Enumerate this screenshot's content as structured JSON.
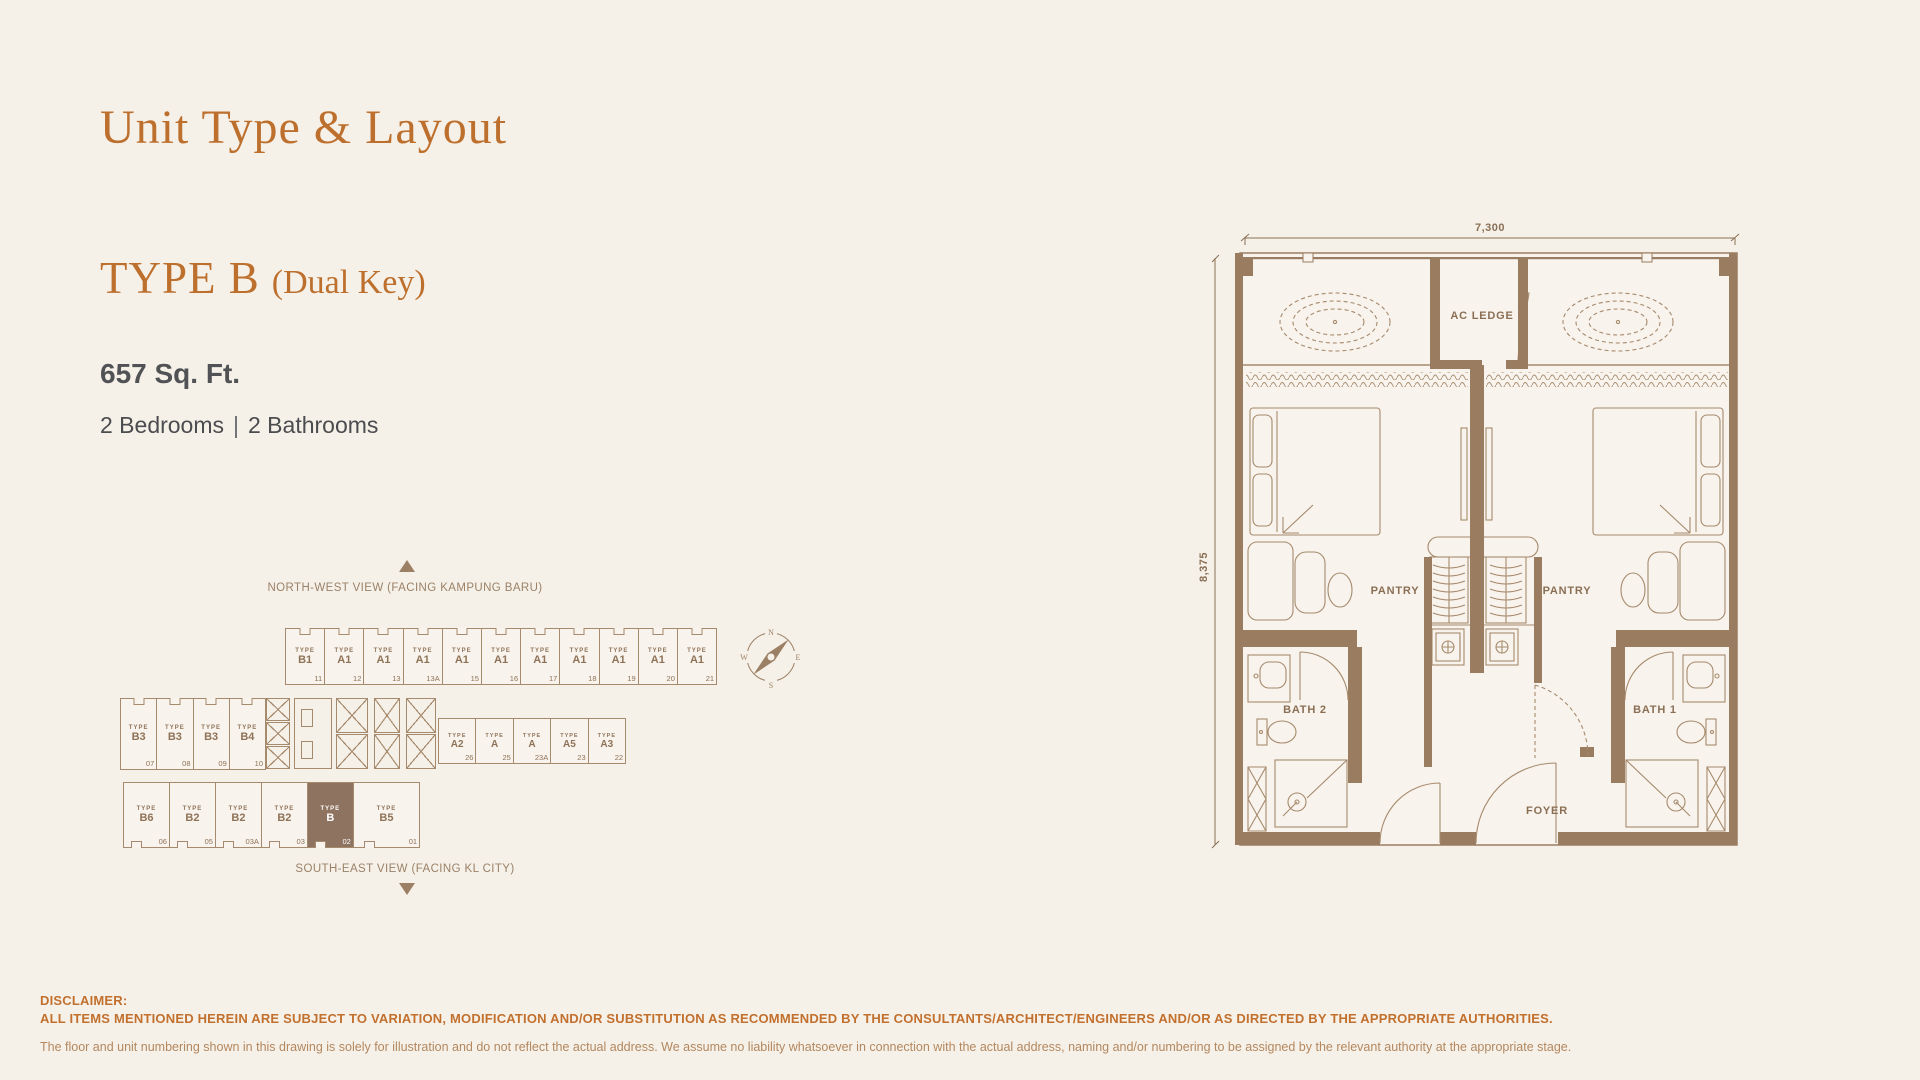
{
  "header": {
    "title": "Unit Type & Layout",
    "unit_type": "TYPE B",
    "unit_qualifier": "(Dual Key)",
    "area": "657 Sq. Ft.",
    "bedrooms": "2 Bedrooms",
    "divider": "|",
    "bathrooms": "2 Bathrooms"
  },
  "floorplate": {
    "type_prefix": "TYPE",
    "north_label": "NORTH-WEST VIEW (FACING KAMPUNG BARU)",
    "south_label": "SOUTH-EAST VIEW (FACING KL CITY)",
    "compass": {
      "n": "N",
      "e": "E",
      "s": "S",
      "w": "W"
    },
    "rows": {
      "top": [
        {
          "type": "B1",
          "no": "11"
        },
        {
          "type": "A1",
          "no": "12"
        },
        {
          "type": "A1",
          "no": "13"
        },
        {
          "type": "A1",
          "no": "13A"
        },
        {
          "type": "A1",
          "no": "15"
        },
        {
          "type": "A1",
          "no": "16"
        },
        {
          "type": "A1",
          "no": "17"
        },
        {
          "type": "A1",
          "no": "18"
        },
        {
          "type": "A1",
          "no": "19"
        },
        {
          "type": "A1",
          "no": "20"
        },
        {
          "type": "A1",
          "no": "21"
        }
      ],
      "middle_left": [
        {
          "type": "B3",
          "no": "07"
        },
        {
          "type": "B3",
          "no": "08"
        },
        {
          "type": "B3",
          "no": "09"
        },
        {
          "type": "B4",
          "no": "10"
        }
      ],
      "middle_right": [
        {
          "type": "A2",
          "no": "26"
        },
        {
          "type": "A",
          "no": "25"
        },
        {
          "type": "A",
          "no": "23A"
        },
        {
          "type": "A5",
          "no": "23"
        },
        {
          "type": "A3",
          "no": "22"
        }
      ],
      "bottom": [
        {
          "type": "B6",
          "no": "06"
        },
        {
          "type": "B2",
          "no": "05"
        },
        {
          "type": "B2",
          "no": "03A"
        },
        {
          "type": "B2",
          "no": "03"
        },
        {
          "type": "B",
          "no": "02",
          "highlight": true
        },
        {
          "type": "B5",
          "no": "01"
        }
      ]
    }
  },
  "floorplan": {
    "dim_width": "7,300",
    "dim_height": "8,375",
    "labels": {
      "ac_ledge": "AC LEDGE",
      "pantry_left": "PANTRY",
      "pantry_right": "PANTRY",
      "bath_2": "BATH 2",
      "bath_1": "BATH 1",
      "foyer": "FOYER"
    }
  },
  "disclaimer": {
    "heading": "DISCLAIMER:",
    "line1": "ALL ITEMS MENTIONED HEREIN ARE SUBJECT TO VARIATION, MODIFICATION AND/OR SUBSTITUTION AS RECOMMENDED BY THE CONSULTANTS/ARCHITECT/ENGINEERS AND/OR AS DIRECTED BY THE APPROPRIATE AUTHORITIES.",
    "line2": "The floor and unit numbering shown in this drawing is solely for illustration and do not reflect the actual address. We assume no liability whatsoever in connection with the actual address, naming and/or numbering to be assigned by the relevant authority at the appropriate stage."
  },
  "colors": {
    "background": "#f6f1e8",
    "accent": "#bd702e",
    "plan_brown": "#9a7c60",
    "line_brown": "#a68a6d",
    "label_brown": "#8a6f55",
    "highlight": "#8d7360",
    "text_dark": "#4f5053",
    "disclaimer_tan": "#b3875f"
  }
}
